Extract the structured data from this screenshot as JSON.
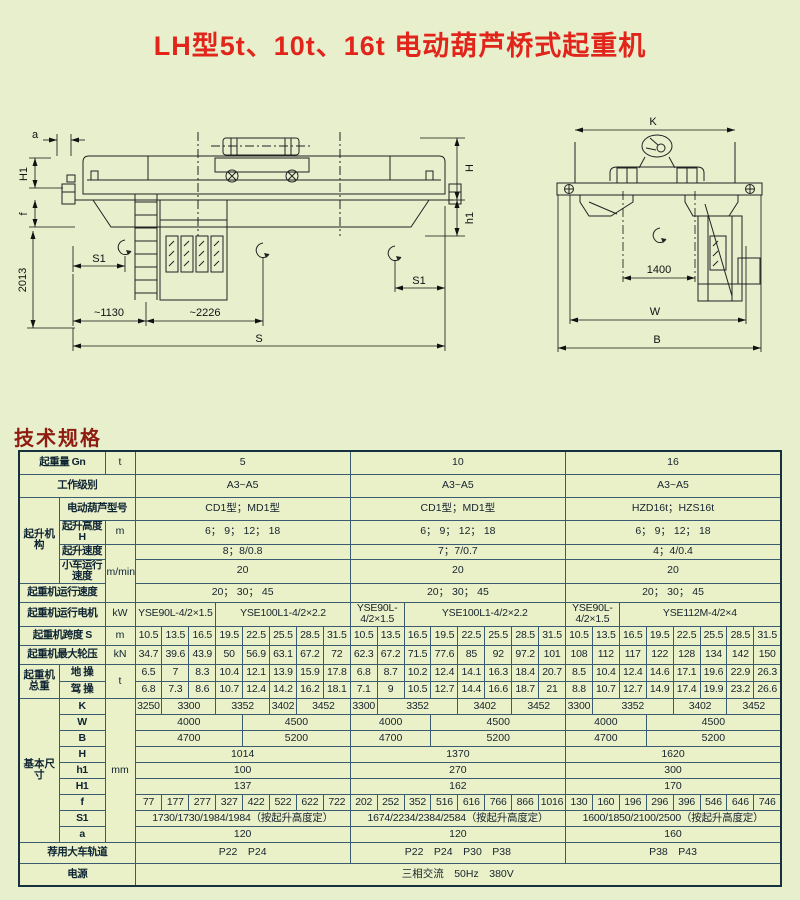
{
  "title": "LH型5t、10t、16t 电动葫芦桥式起重机",
  "section_heading": "技术规格",
  "colors": {
    "background": "#e7efcd",
    "title_red": "#e1251b",
    "heading_red": "#8e1c10",
    "label_blue": "#aeddf0",
    "cell_green": "#eaf0c8",
    "cell_blue": "#d9edf8"
  },
  "diagram": {
    "side": {
      "a": "a",
      "h1_left": "H1",
      "f": "f",
      "v2013": "2013",
      "s1_left": "S1",
      "d1130": "~1130",
      "d2226": "~2226",
      "s": "S",
      "h": "H",
      "h1_right": "h1",
      "s1_right": "S1"
    },
    "end": {
      "k": "K",
      "d1400": "1400",
      "w": "W",
      "b": "B"
    }
  },
  "table": {
    "rows": [
      {
        "cells": [
          {
            "t": "起重量 Gn",
            "k": "l",
            "c": 2
          },
          {
            "t": "t",
            "k": "u"
          },
          {
            "t": "5",
            "c": 8,
            "b": 1
          },
          {
            "t": "10",
            "c": 8,
            "b": 1
          },
          {
            "t": "16",
            "c": 8,
            "b": 1
          }
        ]
      },
      {
        "cells": [
          {
            "t": "工作级别",
            "k": "l",
            "c": 3
          },
          {
            "t": "A3~A5",
            "c": 8,
            "b": 1
          },
          {
            "t": "A3~A5",
            "c": 8,
            "b": 1
          },
          {
            "t": "A3~A5",
            "c": 8,
            "b": 1
          }
        ]
      },
      {
        "cells": [
          {
            "t": "起升机构",
            "k": "g",
            "r": 4
          },
          {
            "t": "电动葫芦型号",
            "k": "l",
            "c": 2
          },
          {
            "t": "CD1型；MD1型",
            "c": 8,
            "b": 1
          },
          {
            "t": "CD1型；MD1型",
            "c": 8,
            "b": 1
          },
          {
            "t": "HZD16t；HZS16t",
            "c": 8,
            "b": 1
          }
        ]
      },
      {
        "cells": [
          {
            "t": "起升高度H",
            "k": "l"
          },
          {
            "t": "m",
            "k": "u"
          },
          {
            "t": "6； 9； 12； 18",
            "c": 8,
            "b": 1
          },
          {
            "t": "6； 9； 12； 18",
            "c": 8,
            "b": 1
          },
          {
            "t": "6； 9； 12； 18",
            "c": 8,
            "b": 1
          }
        ]
      },
      {
        "cells": [
          {
            "t": "起升速度",
            "k": "l"
          },
          {
            "t": "m/min",
            "k": "u",
            "r": 3
          },
          {
            "t": "8；8/0.8",
            "c": 8,
            "b": 1
          },
          {
            "t": "7；7/0.7",
            "c": 8,
            "b": 1
          },
          {
            "t": "4；4/0.4",
            "c": 8,
            "b": 1
          }
        ]
      },
      {
        "cells": [
          {
            "t": "小车运行速度",
            "k": "l"
          },
          {
            "t": "20",
            "c": 8,
            "b": 1
          },
          {
            "t": "20",
            "c": 8,
            "b": 1
          },
          {
            "t": "20",
            "c": 8,
            "b": 1
          }
        ]
      },
      {
        "cells": [
          {
            "t": "起重机运行速度",
            "k": "l",
            "c": 2
          },
          {
            "t": "20； 30； 45",
            "c": 8,
            "b": 1
          },
          {
            "t": "20； 30； 45",
            "c": 8,
            "b": 1
          },
          {
            "t": "20； 30； 45",
            "c": 8,
            "b": 1
          }
        ]
      },
      {
        "cells": [
          {
            "t": "起重机运行电机",
            "k": "l",
            "c": 2
          },
          {
            "t": "kW",
            "k": "u"
          },
          {
            "t": "YSE90L-4/2×1.5",
            "c": 3,
            "b": 1,
            "sm": 1
          },
          {
            "t": "YSE100L1-4/2×2.2",
            "c": 5,
            "sm": 1
          },
          {
            "t": "YSE90L-4/2×1.5",
            "c": 2,
            "b": 1,
            "sm": 1
          },
          {
            "t": "YSE100L1-4/2×2.2",
            "c": 6,
            "sm": 1
          },
          {
            "t": "YSE90L-4/2×1.5",
            "c": 2,
            "b": 1,
            "sm": 1
          },
          {
            "t": "YSE112M-4/2×4",
            "c": 6,
            "sm": 1
          }
        ]
      },
      {
        "cells": [
          {
            "t": "起重机跨度 S",
            "k": "l",
            "c": 2
          },
          {
            "t": "m",
            "k": "u"
          },
          {
            "t": "10.5",
            "b": 1,
            "sm": 1
          },
          {
            "t": "13.5",
            "sm": 1
          },
          {
            "t": "16.5",
            "sm": 1
          },
          {
            "t": "19.5",
            "sm": 1
          },
          {
            "t": "22.5",
            "sm": 1
          },
          {
            "t": "25.5",
            "sm": 1
          },
          {
            "t": "28.5",
            "sm": 1
          },
          {
            "t": "31.5",
            "sm": 1
          },
          {
            "t": "10.5",
            "b": 1,
            "sm": 1
          },
          {
            "t": "13.5",
            "sm": 1
          },
          {
            "t": "16.5",
            "sm": 1
          },
          {
            "t": "19.5",
            "sm": 1
          },
          {
            "t": "22.5",
            "sm": 1
          },
          {
            "t": "25.5",
            "sm": 1
          },
          {
            "t": "28.5",
            "sm": 1
          },
          {
            "t": "31.5",
            "sm": 1
          },
          {
            "t": "10.5",
            "b": 1,
            "sm": 1
          },
          {
            "t": "13.5",
            "sm": 1
          },
          {
            "t": "16.5",
            "sm": 1
          },
          {
            "t": "19.5",
            "sm": 1
          },
          {
            "t": "22.5",
            "sm": 1
          },
          {
            "t": "25.5",
            "sm": 1
          },
          {
            "t": "28.5",
            "sm": 1
          },
          {
            "t": "31.5",
            "sm": 1
          }
        ]
      },
      {
        "cells": [
          {
            "t": "起重机最大轮压",
            "k": "l",
            "c": 2
          },
          {
            "t": "kN",
            "k": "u"
          },
          {
            "t": "34.7",
            "b": 1,
            "sm": 1
          },
          {
            "t": "39.6",
            "sm": 1
          },
          {
            "t": "43.9",
            "sm": 1
          },
          {
            "t": "50",
            "sm": 1
          },
          {
            "t": "56.9",
            "sm": 1
          },
          {
            "t": "63.1",
            "sm": 1
          },
          {
            "t": "67.2",
            "sm": 1
          },
          {
            "t": "72",
            "sm": 1
          },
          {
            "t": "62.3",
            "b": 1,
            "sm": 1
          },
          {
            "t": "67.2",
            "sm": 1
          },
          {
            "t": "71.5",
            "sm": 1
          },
          {
            "t": "77.6",
            "sm": 1
          },
          {
            "t": "85",
            "sm": 1
          },
          {
            "t": "92",
            "sm": 1
          },
          {
            "t": "97.2",
            "sm": 1
          },
          {
            "t": "101",
            "sm": 1
          },
          {
            "t": "108",
            "b": 1,
            "sm": 1
          },
          {
            "t": "112",
            "sm": 1
          },
          {
            "t": "117",
            "sm": 1
          },
          {
            "t": "122",
            "sm": 1
          },
          {
            "t": "128",
            "sm": 1
          },
          {
            "t": "134",
            "sm": 1
          },
          {
            "t": "142",
            "sm": 1
          },
          {
            "t": "150",
            "sm": 1
          }
        ]
      },
      {
        "cells": [
          {
            "t": "起重机总重",
            "k": "g",
            "r": 2
          },
          {
            "t": "地 操",
            "k": "l"
          },
          {
            "t": "t",
            "k": "u",
            "r": 2
          },
          {
            "t": "6.5",
            "b": 1,
            "sm": 1
          },
          {
            "t": "7",
            "sm": 1
          },
          {
            "t": "8.3",
            "sm": 1
          },
          {
            "t": "10.4",
            "sm": 1
          },
          {
            "t": "12.1",
            "sm": 1
          },
          {
            "t": "13.9",
            "sm": 1
          },
          {
            "t": "15.9",
            "sm": 1
          },
          {
            "t": "17.8",
            "sm": 1
          },
          {
            "t": "6.8",
            "b": 1,
            "sm": 1
          },
          {
            "t": "8.7",
            "sm": 1
          },
          {
            "t": "10.2",
            "sm": 1
          },
          {
            "t": "12.4",
            "sm": 1
          },
          {
            "t": "14.1",
            "sm": 1
          },
          {
            "t": "16.3",
            "sm": 1
          },
          {
            "t": "18.4",
            "sm": 1
          },
          {
            "t": "20.7",
            "sm": 1
          },
          {
            "t": "8.5",
            "b": 1,
            "sm": 1
          },
          {
            "t": "10.4",
            "sm": 1
          },
          {
            "t": "12.4",
            "sm": 1
          },
          {
            "t": "14.6",
            "sm": 1
          },
          {
            "t": "17.1",
            "sm": 1
          },
          {
            "t": "19.6",
            "sm": 1
          },
          {
            "t": "22.9",
            "sm": 1
          },
          {
            "t": "26.3",
            "sm": 1
          }
        ]
      },
      {
        "cells": [
          {
            "t": "驾 操",
            "k": "l"
          },
          {
            "t": "6.8",
            "b": 1,
            "sm": 1
          },
          {
            "t": "7.3",
            "sm": 1
          },
          {
            "t": "8.6",
            "sm": 1
          },
          {
            "t": "10.7",
            "sm": 1
          },
          {
            "t": "12.4",
            "sm": 1
          },
          {
            "t": "14.2",
            "sm": 1
          },
          {
            "t": "16.2",
            "sm": 1
          },
          {
            "t": "18.1",
            "sm": 1
          },
          {
            "t": "7.1",
            "b": 1,
            "sm": 1
          },
          {
            "t": "9",
            "sm": 1
          },
          {
            "t": "10.5",
            "sm": 1
          },
          {
            "t": "12.7",
            "sm": 1
          },
          {
            "t": "14.4",
            "sm": 1
          },
          {
            "t": "16.6",
            "sm": 1
          },
          {
            "t": "18.7",
            "sm": 1
          },
          {
            "t": "21",
            "sm": 1
          },
          {
            "t": "8.8",
            "b": 1,
            "sm": 1
          },
          {
            "t": "10.7",
            "sm": 1
          },
          {
            "t": "12.7",
            "sm": 1
          },
          {
            "t": "14.9",
            "sm": 1
          },
          {
            "t": "17.4",
            "sm": 1
          },
          {
            "t": "19.9",
            "sm": 1
          },
          {
            "t": "23.2",
            "sm": 1
          },
          {
            "t": "26.6",
            "sm": 1
          }
        ]
      },
      {
        "cells": [
          {
            "t": "基本尺寸",
            "k": "g",
            "r": 9
          },
          {
            "t": "K",
            "k": "l"
          },
          {
            "t": "mm",
            "k": "u",
            "r": 9
          },
          {
            "t": "3250",
            "b": 1,
            "sm": 1
          },
          {
            "t": "3300",
            "c": 2,
            "sm": 1
          },
          {
            "t": "3352",
            "c": 2,
            "sm": 1
          },
          {
            "t": "3402",
            "sm": 1
          },
          {
            "t": "3452",
            "c": 2,
            "sm": 1
          },
          {
            "t": "3300",
            "b": 1,
            "sm": 1
          },
          {
            "t": "3352",
            "c": 3,
            "sm": 1
          },
          {
            "t": "3402",
            "c": 2,
            "sm": 1
          },
          {
            "t": "3452",
            "c": 2,
            "sm": 1
          },
          {
            "t": "3300",
            "b": 1,
            "sm": 1
          },
          {
            "t": "3352",
            "c": 3,
            "sm": 1
          },
          {
            "t": "3402",
            "c": 2,
            "sm": 1
          },
          {
            "t": "3452",
            "c": 2,
            "sm": 1
          }
        ]
      },
      {
        "cells": [
          {
            "t": "W",
            "k": "l"
          },
          {
            "t": "4000",
            "c": 4,
            "b": 1
          },
          {
            "t": "4500",
            "c": 4
          },
          {
            "t": "4000",
            "c": 3,
            "b": 1
          },
          {
            "t": "4500",
            "c": 5
          },
          {
            "t": "4000",
            "c": 3,
            "b": 1
          },
          {
            "t": "4500",
            "c": 5
          }
        ]
      },
      {
        "cells": [
          {
            "t": "B",
            "k": "l"
          },
          {
            "t": "4700",
            "c": 4,
            "b": 1
          },
          {
            "t": "5200",
            "c": 4
          },
          {
            "t": "4700",
            "c": 3,
            "b": 1
          },
          {
            "t": "5200",
            "c": 5
          },
          {
            "t": "4700",
            "c": 3,
            "b": 1
          },
          {
            "t": "5200",
            "c": 5
          }
        ]
      },
      {
        "cells": [
          {
            "t": "H",
            "k": "l"
          },
          {
            "t": "1014",
            "c": 8,
            "b": 1
          },
          {
            "t": "1370",
            "c": 8,
            "b": 1
          },
          {
            "t": "1620",
            "c": 8,
            "b": 1
          }
        ]
      },
      {
        "cells": [
          {
            "t": "h1",
            "k": "l"
          },
          {
            "t": "100",
            "c": 8,
            "b": 1
          },
          {
            "t": "270",
            "c": 8,
            "b": 1
          },
          {
            "t": "300",
            "c": 8,
            "b": 1
          }
        ]
      },
      {
        "cells": [
          {
            "t": "H1",
            "k": "l"
          },
          {
            "t": "137",
            "c": 8,
            "b": 1
          },
          {
            "t": "162",
            "c": 8,
            "b": 1
          },
          {
            "t": "170",
            "c": 8,
            "b": 1
          }
        ]
      },
      {
        "cells": [
          {
            "t": "f",
            "k": "l"
          },
          {
            "t": "77",
            "b": 1,
            "sm": 1
          },
          {
            "t": "177",
            "sm": 1
          },
          {
            "t": "277",
            "sm": 1
          },
          {
            "t": "327",
            "sm": 1
          },
          {
            "t": "422",
            "sm": 1
          },
          {
            "t": "522",
            "sm": 1
          },
          {
            "t": "622",
            "sm": 1
          },
          {
            "t": "722",
            "sm": 1
          },
          {
            "t": "202",
            "b": 1,
            "sm": 1
          },
          {
            "t": "252",
            "sm": 1
          },
          {
            "t": "352",
            "sm": 1
          },
          {
            "t": "516",
            "sm": 1
          },
          {
            "t": "616",
            "sm": 1
          },
          {
            "t": "766",
            "sm": 1
          },
          {
            "t": "866",
            "sm": 1
          },
          {
            "t": "1016",
            "sm": 1
          },
          {
            "t": "130",
            "b": 1,
            "sm": 1
          },
          {
            "t": "160",
            "sm": 1
          },
          {
            "t": "196",
            "sm": 1
          },
          {
            "t": "296",
            "sm": 1
          },
          {
            "t": "396",
            "sm": 1
          },
          {
            "t": "546",
            "sm": 1
          },
          {
            "t": "646",
            "sm": 1
          },
          {
            "t": "746",
            "sm": 1
          }
        ]
      },
      {
        "cells": [
          {
            "t": "S1",
            "k": "l"
          },
          {
            "t": "1730/1730/1984/1984（按起升高度定）",
            "c": 8,
            "b": 1,
            "s": 0,
            "sm": 1
          },
          {
            "t": "1674/2234/2384/2584（按起升高度定）",
            "c": 8,
            "b": 1,
            "s": 0,
            "sm": 1
          },
          {
            "t": "1600/1850/2100/2500（按起升高度定）",
            "c": 8,
            "b": 1,
            "s": 0,
            "sm": 1
          }
        ]
      },
      {
        "cells": [
          {
            "t": "a",
            "k": "l"
          },
          {
            "t": "120",
            "c": 8,
            "b": 1,
            "s": 1
          },
          {
            "t": "120",
            "c": 8,
            "b": 1,
            "s": 0
          },
          {
            "t": "160",
            "c": 8,
            "b": 1,
            "s": 1
          }
        ]
      },
      {
        "cells": [
          {
            "t": "荐用大车轨道",
            "k": "l",
            "c": 3
          },
          {
            "t": "P22　P24",
            "c": 8,
            "b": 1,
            "s": 0
          },
          {
            "t": "P22　P24　P30　P38",
            "c": 8,
            "b": 1,
            "s": 0
          },
          {
            "t": "P38　P43",
            "c": 8,
            "b": 1,
            "s": 0
          }
        ]
      },
      {
        "cells": [
          {
            "t": "电源",
            "k": "l",
            "c": 3
          },
          {
            "t": "三相交流　50Hz　380V",
            "c": 24,
            "b": 1,
            "s": 0
          }
        ]
      }
    ]
  }
}
